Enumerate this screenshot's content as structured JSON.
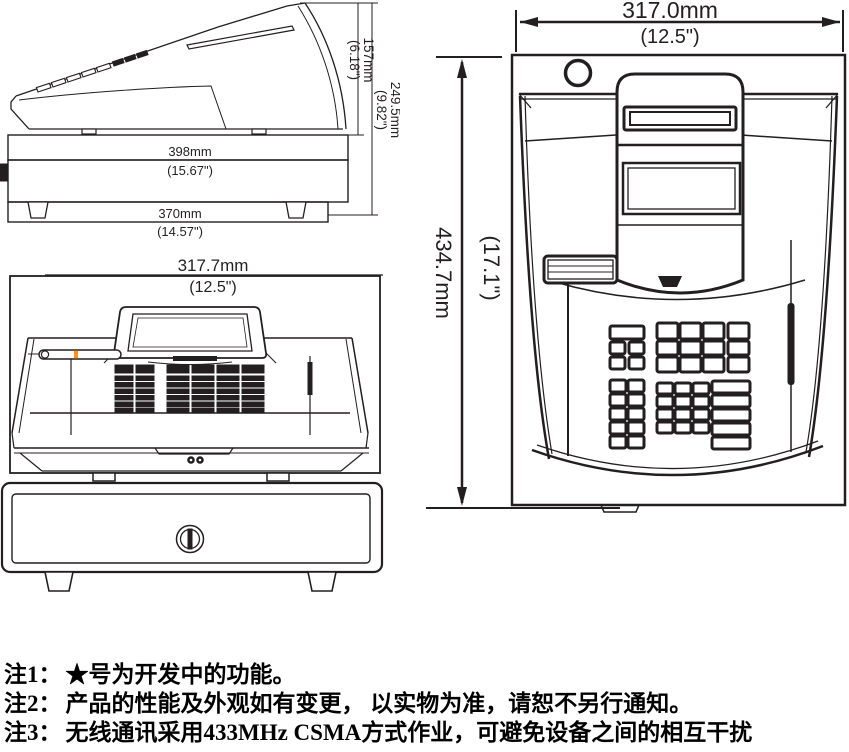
{
  "colors": {
    "line": "#231f20",
    "accent": "#f7941d",
    "background": "#ffffff"
  },
  "side_view": {
    "dim_display_height_mm": "157mm",
    "dim_display_height_in": "(6.18\")",
    "dim_total_height_mm": "249.5mm",
    "dim_total_height_in": "(9.82\")",
    "dim_depth_mm": "398mm",
    "dim_depth_in": "(15.67\")",
    "dim_base_depth_mm": "370mm",
    "dim_base_depth_in": "(14.57\")"
  },
  "front_view": {
    "dim_width_mm": "317.7mm",
    "dim_width_in": "(12.5\")"
  },
  "top_view": {
    "dim_width_mm": "317.0mm",
    "dim_width_in": "(12.5\")",
    "dim_depth_mm": "434.7mm",
    "dim_depth_in": "(17.1\")"
  },
  "notes": [
    {
      "label": "注1：",
      "text": "★号为开发中的功能。"
    },
    {
      "label": "注2：",
      "text": "产品的性能及外观如有变更， 以实物为准，请恕不另行通知。"
    },
    {
      "label": "注3：",
      "text": "无线通讯采用433MHz CSMA方式作业，可避免设备之间的相互干扰"
    }
  ]
}
